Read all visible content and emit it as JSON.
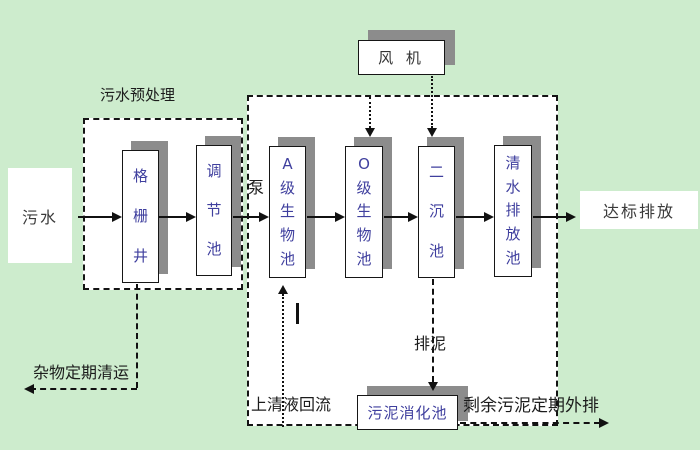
{
  "colors": {
    "bg": "#cdeccd",
    "ink": "#1c1c1c",
    "tank-text": "#3f3f9e",
    "shadow": "#8c8c8c",
    "paper": "#ffffff"
  },
  "labels": {
    "pretreatment_zone": "污水预处理",
    "influent": "污水",
    "pump": "泵",
    "blower": "风 机",
    "discharge": "达标排放",
    "debris_removal": "杂物定期清运",
    "supernatant_return": "上清液回流",
    "sludge_drain": "排泥",
    "excess_sludge": "剩余污泥定期外排"
  },
  "tanks": {
    "grid_well": "格栅井",
    "regulating": "调节池",
    "a_bio": "A级生物池",
    "o_bio": "O级生物池",
    "secondary_clarifier": "二沉池",
    "clear_water": "清水排放池",
    "sludge_digester": "污泥消化池"
  }
}
